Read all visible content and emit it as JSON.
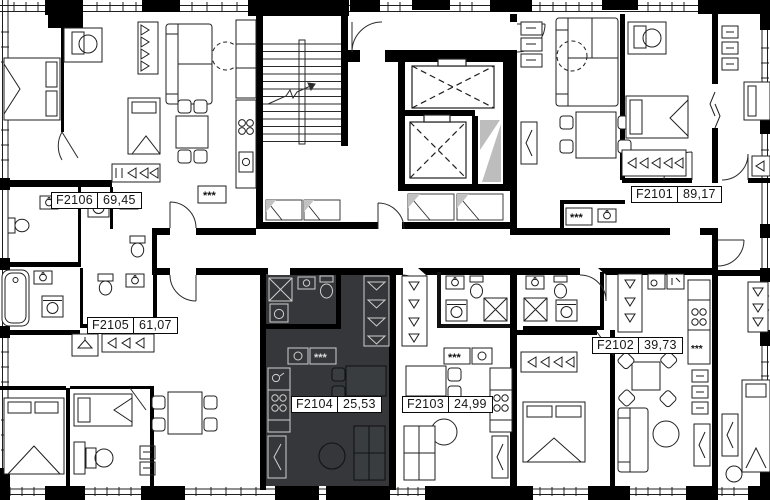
{
  "plan": {
    "type": "residential-floor-plan",
    "colors": {
      "background": "#ffffff",
      "walls": "#000000",
      "thin_lines": "#1f1f1f",
      "selected_unit_fill": "#35373a",
      "selected_unit_fixture_lines": "#cfcfcf",
      "shaft_hatch": "#bdbdbd",
      "label_background": "#ffffff",
      "label_border": "#0a0a0a",
      "label_text": "#161616"
    },
    "symbols": {
      "vent": "***"
    },
    "units": [
      {
        "id": "F2101",
        "area": "89,17",
        "highlighted": false
      },
      {
        "id": "F2102",
        "area": "39,73",
        "highlighted": false
      },
      {
        "id": "F2103",
        "area": "24,99",
        "highlighted": false
      },
      {
        "id": "F2104",
        "area": "25,53",
        "highlighted": true
      },
      {
        "id": "F2105",
        "area": "61,07",
        "highlighted": false
      },
      {
        "id": "F2106",
        "area": "69,45",
        "highlighted": false
      }
    ]
  }
}
